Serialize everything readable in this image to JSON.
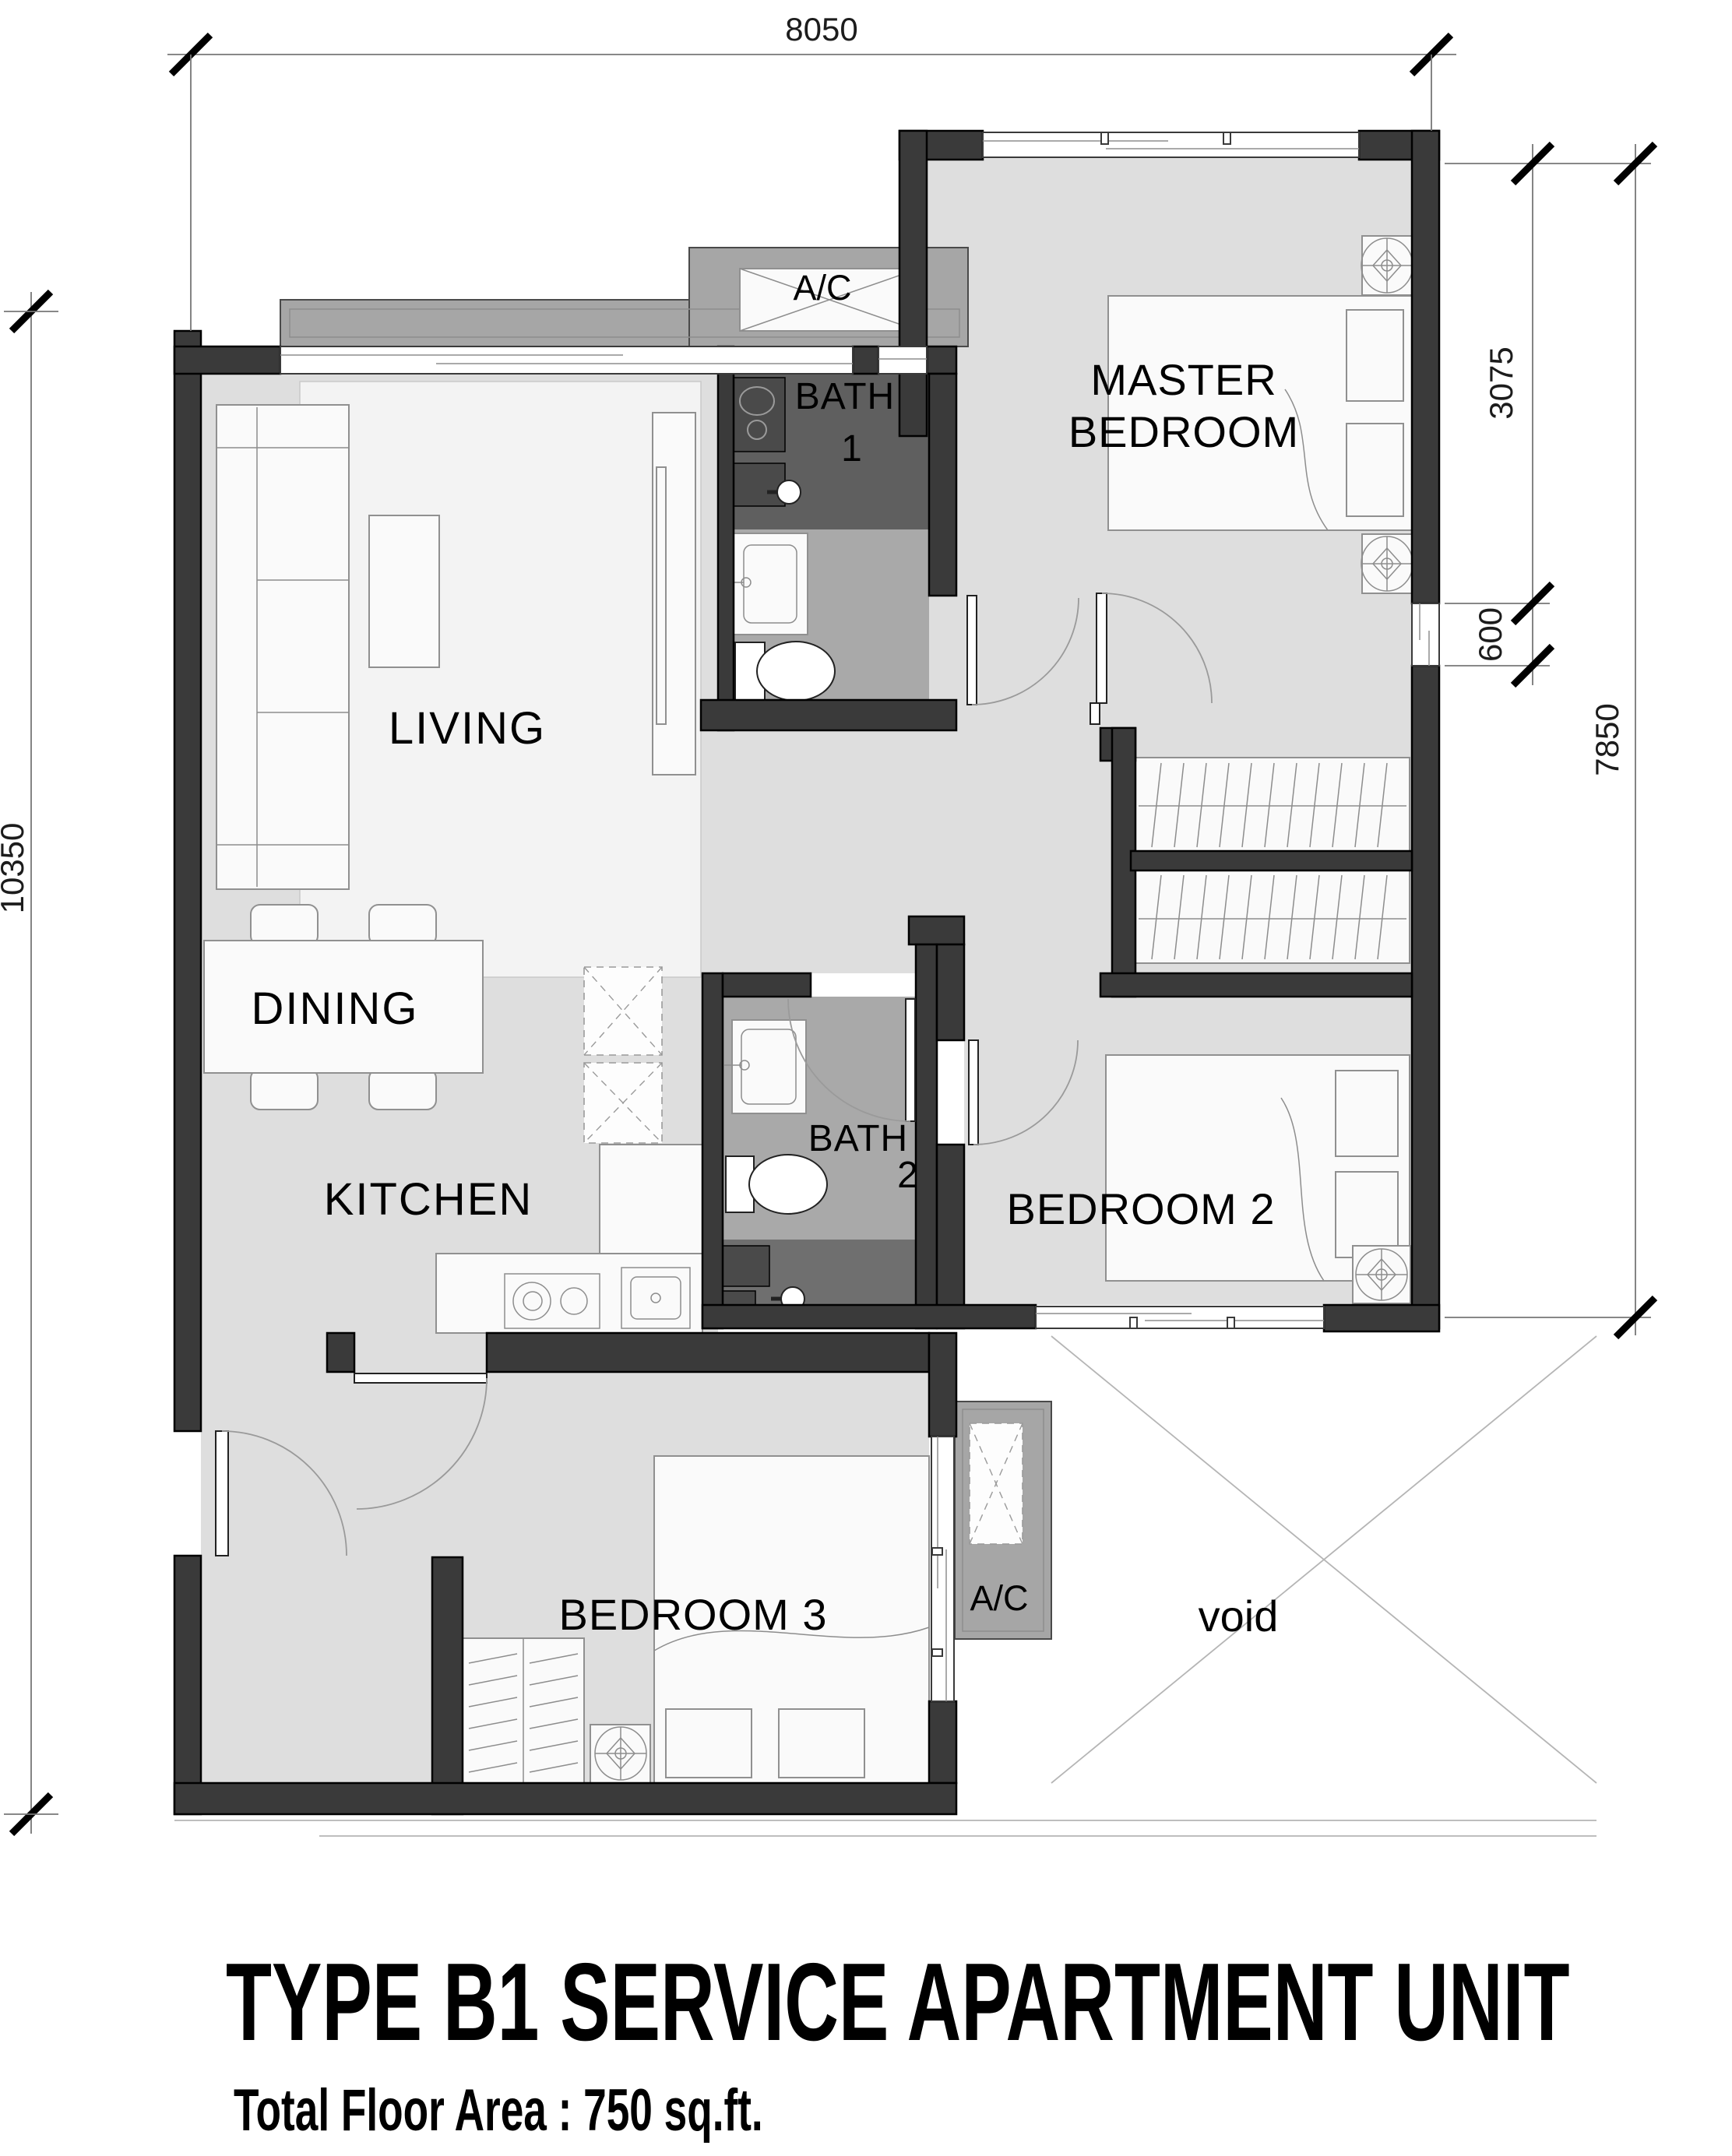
{
  "plan": {
    "title": "TYPE B1 SERVICE APARTMENT UNIT",
    "subtitle": "Total Floor Area : 750 sq.ft.",
    "rooms": {
      "living": "LIVING",
      "dining": "DINING",
      "kitchen": "KITCHEN",
      "master_line1": "MASTER",
      "master_line2": "BEDROOM",
      "bedroom2": "BEDROOM 2",
      "bedroom3": "BEDROOM 3",
      "bath1_line1": "BATH",
      "bath1_line2": "1",
      "bath2_line1": "BATH",
      "bath2_line2": "2",
      "void_label": "void",
      "ac_top": "A/C",
      "ac_bottom": "A/C"
    },
    "dimensions": {
      "top": "8050",
      "left": "10350",
      "right_upper": "3075",
      "right_window": "600",
      "right_overall": "7850"
    }
  }
}
